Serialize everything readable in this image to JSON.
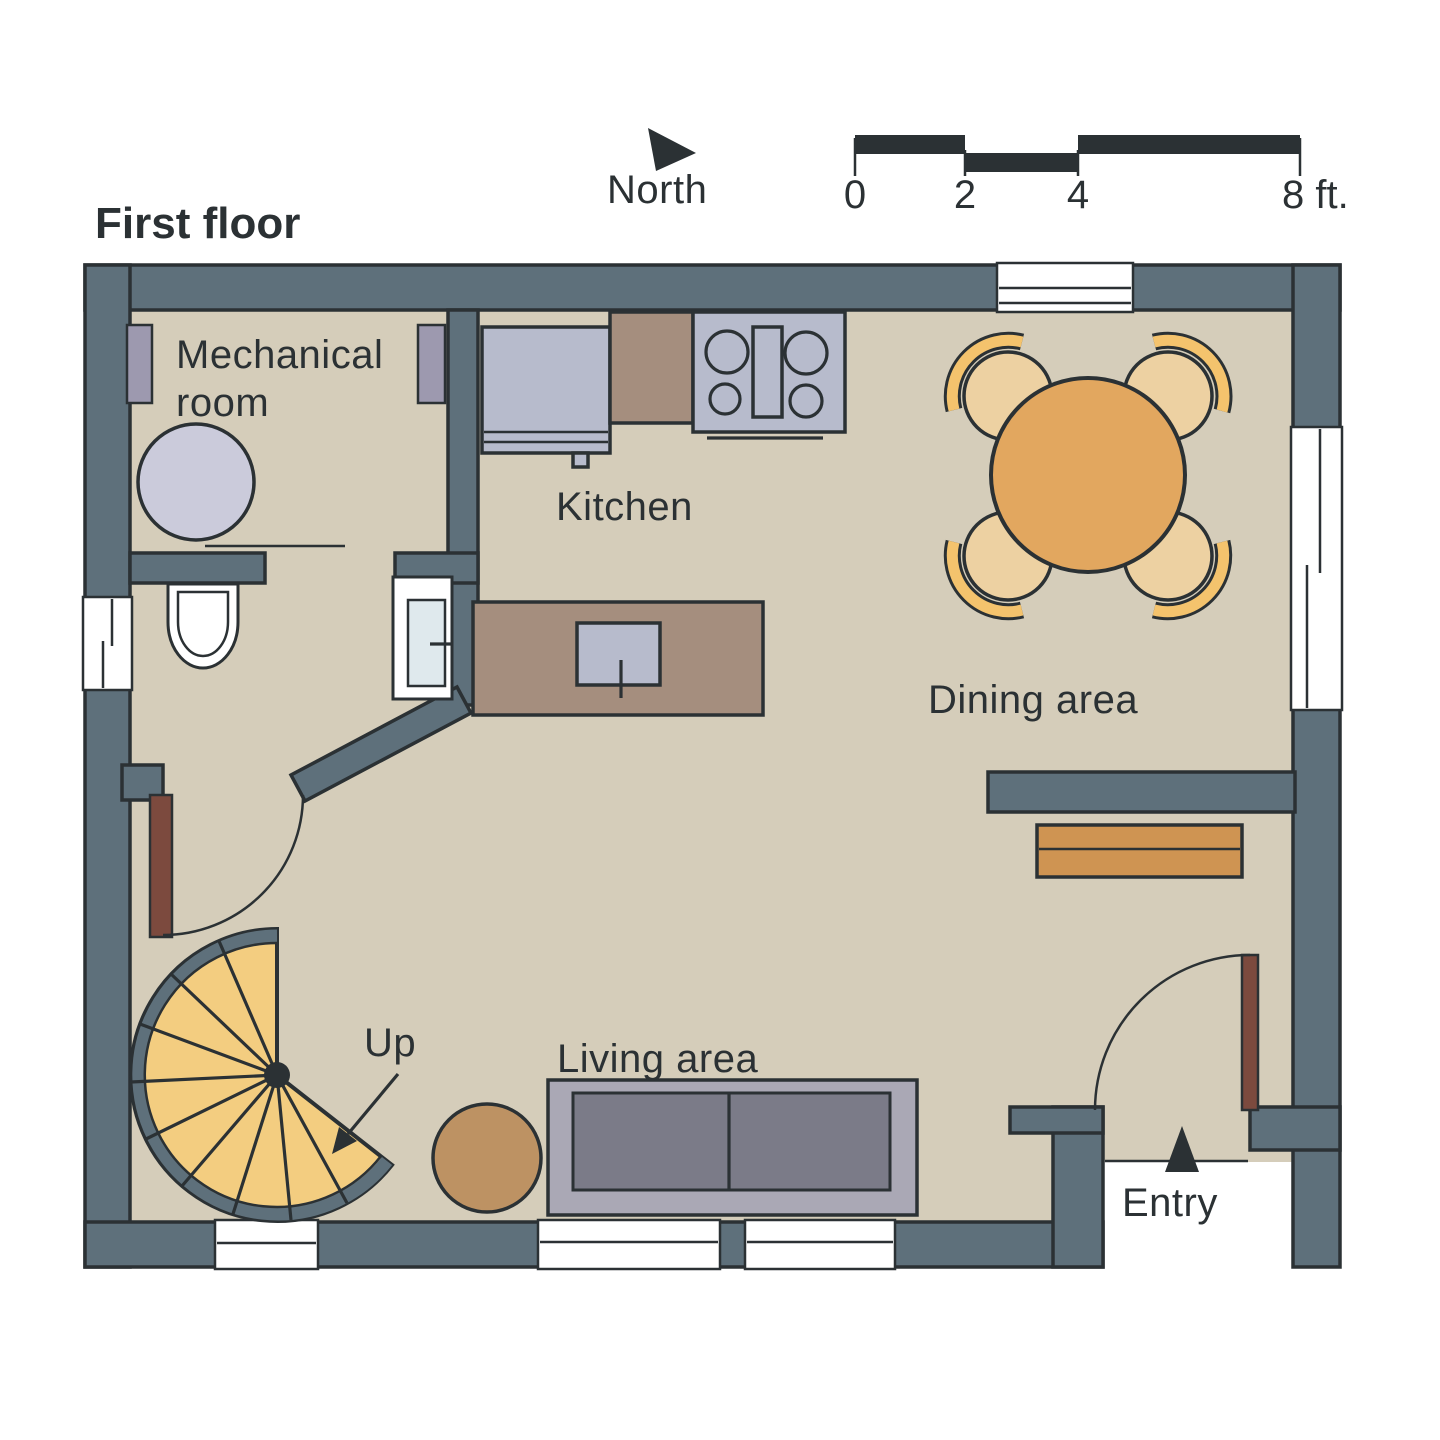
{
  "title": "First floor",
  "compass": {
    "label": "North"
  },
  "scale_bar": {
    "unit_labels": {
      "t0": "0",
      "t2": "2",
      "t4": "4",
      "t8": "8 ft."
    },
    "segments_ft": [
      [
        0,
        2
      ],
      [
        2,
        4
      ],
      [
        4,
        8
      ]
    ]
  },
  "rooms": {
    "mechanical": {
      "label_line1": "Mechanical",
      "label_line2": "room"
    },
    "kitchen": {
      "label": "Kitchen"
    },
    "dining": {
      "label": "Dining area"
    },
    "living": {
      "label": "Living area"
    }
  },
  "stairs": {
    "up_label": "Up"
  },
  "entry": {
    "label": "Entry"
  },
  "icons": {
    "north_arrow": "filled-triangle-pointer",
    "entry_arrow": "filled-triangle-up",
    "up_arrow": "line-arrow-down-left"
  },
  "fixtures": [
    "water-heater",
    "toilet",
    "vanity-sink",
    "refrigerator",
    "stove",
    "kitchen-island-sink",
    "dining-table",
    "dining-chairs",
    "console-bench",
    "sofa",
    "side-table",
    "spiral-staircase",
    "bathroom-door",
    "entry-door"
  ],
  "colors": {
    "ink": "#2B3134",
    "wall": "#5E707B",
    "floor": "#D5CDBA",
    "counter_brown": "#A58E7E",
    "appliance_gray": "#B7BBCC",
    "equipment_purple": "#9D99AF",
    "water_heater": "#CBCBDB",
    "sink_blue": "#DFE9ED",
    "table_orange": "#E2A75F",
    "chair_tan": "#EDD1A2",
    "chair_back_gold": "#F4C36D",
    "bench_orange": "#CF9452",
    "sofa_light": "#AAA8B5",
    "sofa_dark": "#7B7B88",
    "side_table_brown": "#BD9263",
    "stair_yellow": "#F3CD80",
    "door_brown": "#7C4A3E"
  }
}
